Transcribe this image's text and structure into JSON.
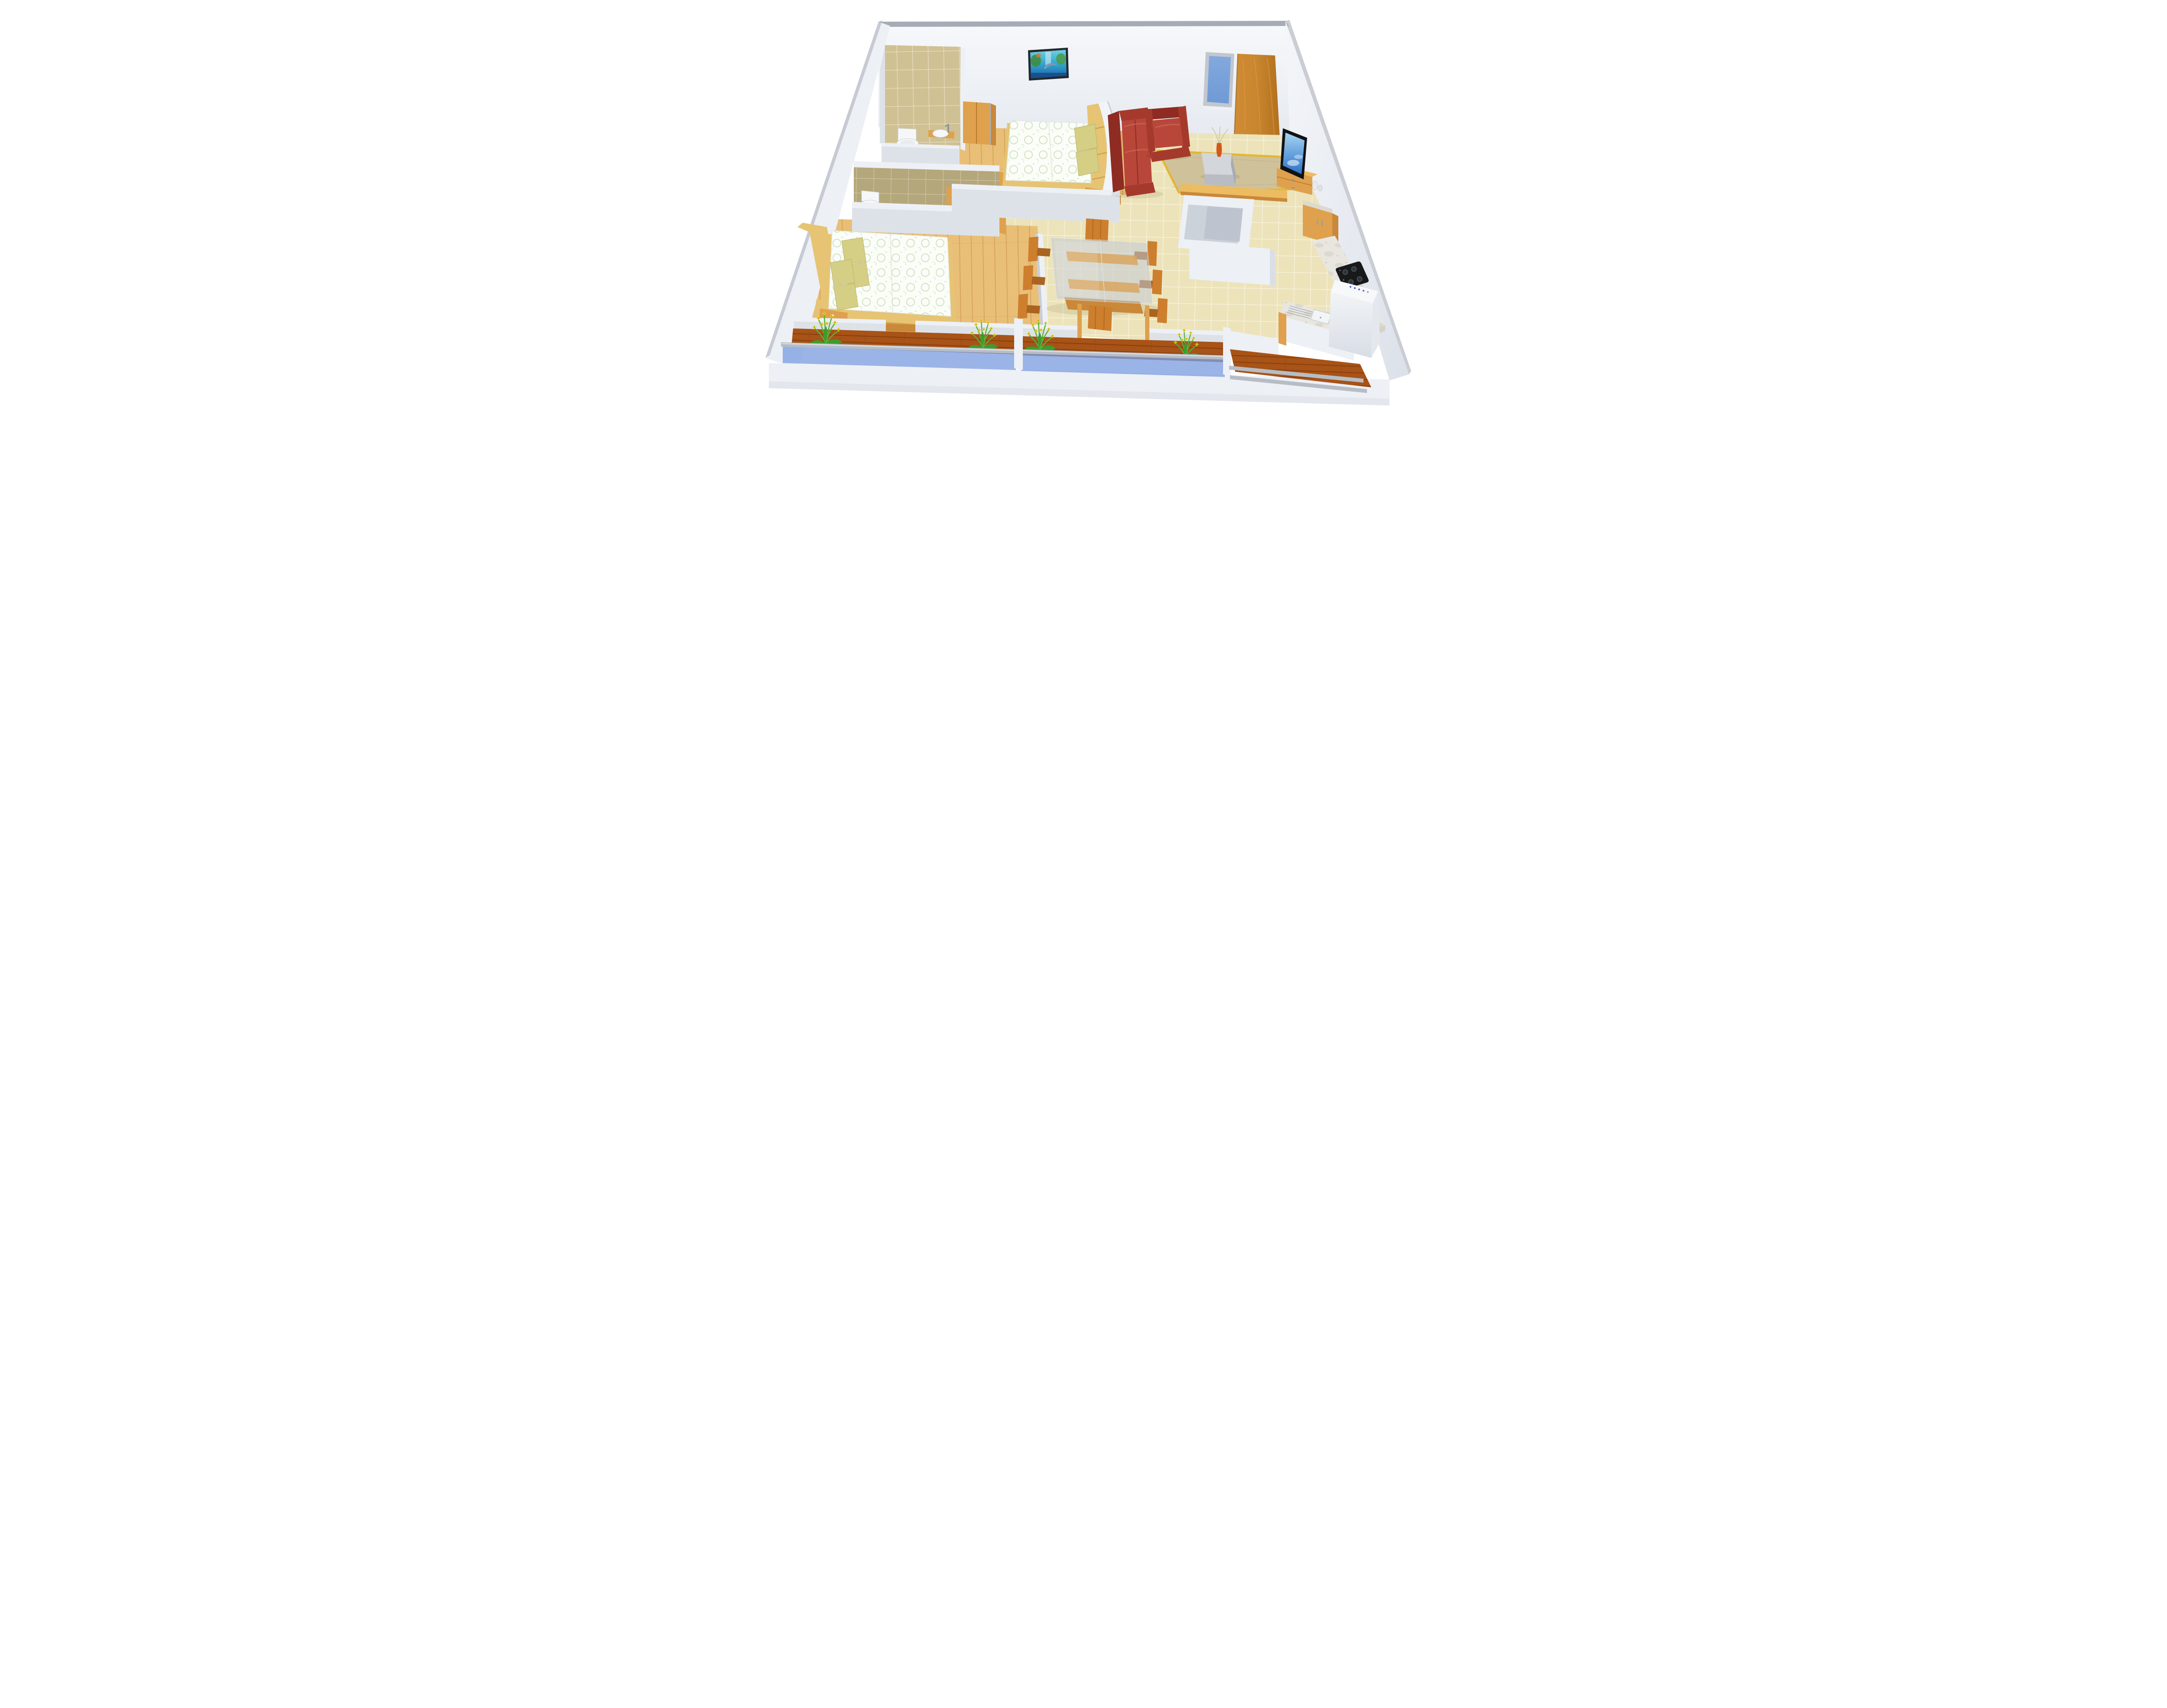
{
  "meta": {
    "title": "3D cutaway floor plan render of a 2BHK apartment",
    "view": "elevated front perspective, roofless dollhouse style",
    "background": "#ffffff",
    "visible_text": "none"
  },
  "palette": {
    "wallFace": "#edf0f5",
    "wallShade": "#dde2e9",
    "wallCap": "#a6acb6",
    "backWallTop": "#f6f8fb",
    "backWallBottom": "#e6eaf0",
    "slabFront": "#e3e6ec",
    "tileBase": "#ece3ba",
    "tileGrout": "#f7f2dc",
    "bathTile1": "#cfc194",
    "bathGrout1": "#e8e0c2",
    "bathTile2": "#b4a77b",
    "bathGrout2": "#cfc6a6",
    "woodFloor": "#e9bf78",
    "woodFloorLine": "#d8a55c",
    "deck": "#a85317",
    "deckLine": "#8d3f0d",
    "woodLight": "#e6c473",
    "woodMid": "#dfa14e",
    "woodDark": "#c9883a",
    "woodTop": "#edbb60",
    "doorWood": "#c8862f",
    "sheet": "#fbfdf9",
    "sheetGreen": "#accf8e",
    "pillow": "#d5cf86",
    "sofaDark": "#8e2b22",
    "sofaMid": "#a53a2c",
    "sofaLight": "#b8473a",
    "rug": "#cfc29a",
    "rugBorder": "#e2b736",
    "glass": "#7e9fe0",
    "rail": "#b7bdc5",
    "windowGlass": "#6f9ad6",
    "windowFrame": "#c2c7cf",
    "tvBlack": "#101214",
    "tvScreenHi": "#a6d4f2",
    "tvScreenLo": "#2c72c8",
    "marble": "#e9e6e0",
    "marbleVein": "#d8d4cb",
    "hob": "#17191b",
    "flower": "#e8d820",
    "leaf": "#3f9b2e",
    "stem": "#57b33a",
    "ceramic": "#f5f7f8",
    "steel": "#9aa2ab",
    "washerBlue": "#4b5cd8",
    "chair": "#cd7f2e",
    "chairDark": "#aa6420",
    "vaseOrange": "#d2591a"
  },
  "rooms": [
    {
      "name": "bathroom-1",
      "floor": "tan tile",
      "furniture": [
        "wall-hung toilet",
        "round countertop washbasin with tall chrome faucet",
        "wooden vanity"
      ]
    },
    {
      "name": "bedroom-1",
      "floor": "light wood planks",
      "furniture": [
        "double bed with white-green floral duvet",
        "two olive pillows",
        "wooden headboard shelf",
        "bedside table",
        "wardrobe cabinet",
        "dolphin waterfall wall art"
      ]
    },
    {
      "name": "living-room",
      "floor": "beige marble tile",
      "furniture": [
        "red leather two-seat sofa",
        "red leather armchair",
        "beige rug with gold border",
        "grey glass coffee table",
        "orange flute vase with twigs",
        "wooden TV sideboard",
        "flat-screen TV showing sky",
        "white ceramic vases"
      ]
    },
    {
      "name": "dining-area",
      "floor": "beige marble tile",
      "furniture": [
        "rectangular glass-top table with wooden runner",
        "eight wooden high-back chairs",
        "wooden floor platform"
      ]
    },
    {
      "name": "kitchen",
      "floor": "beige marble tile",
      "furniture": [
        "wooden breakfast bar on white masonry base",
        "white island wall",
        "tall wooden cabinet with chrome handles",
        "granite counter along right wall",
        "black four-burner gas hob",
        "double-bowl sink with drainboard",
        "wooden base cabinets"
      ]
    },
    {
      "name": "bathroom-2",
      "floor": "olive tile",
      "furniture": [
        "toilet",
        "white vessel washbasin on wooden counter",
        "chrome faucet",
        "wooden door frame"
      ]
    },
    {
      "name": "bedroom-2",
      "floor": "light wood planks",
      "furniture": [
        "double bed with white-green floral duvet",
        "four olive pillows",
        "long wooden headboard with shelves",
        "bedside drawer unit"
      ]
    },
    {
      "name": "balcony-left",
      "floor": "dark wood deck",
      "furniture": [
        "blue glass railing with grey handrail",
        "two yellow-flower planters"
      ]
    },
    {
      "name": "balcony-center",
      "floor": "dark wood deck",
      "furniture": [
        "blue glass railing with grey handrail",
        "two yellow-flower planters"
      ]
    },
    {
      "name": "utility-balcony",
      "floor": "dark wood deck",
      "furniture": [
        "two grey railing bars",
        "white washing machine with blue control dots"
      ]
    }
  ],
  "features": {
    "window": "blue glass window with grey frame on back wall",
    "door": "light brown wooden entry door on back wall",
    "wall_art": "dolphin leaping before waterfall, teal and green painting",
    "walls": "white cutaway walls with grey top caps",
    "base": "white display slab under the apartment"
  }
}
